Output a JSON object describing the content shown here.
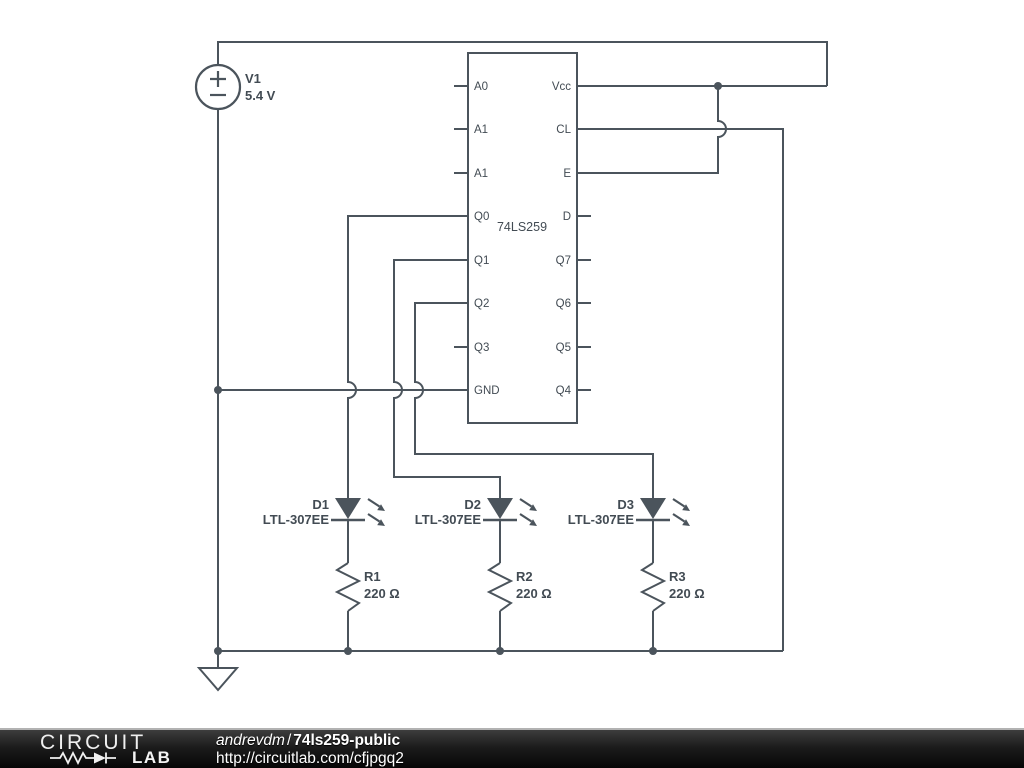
{
  "colors": {
    "wire": "#4b545c",
    "label": "#424b53",
    "footer_text": "#ffffff",
    "footer_bg_top": "#3d3d3d",
    "footer_bg_bottom": "#060606"
  },
  "schematic": {
    "voltage_source": {
      "name": "V1",
      "value": "5.4 V"
    },
    "ic": {
      "label": "74LS259",
      "left_pins": [
        "A0",
        "A1",
        "A1",
        "Q0",
        "Q1",
        "Q2",
        "Q3",
        "GND"
      ],
      "right_pins": [
        "Vcc",
        "CL",
        "E",
        "D",
        "Q7",
        "Q6",
        "Q5",
        "Q4"
      ]
    },
    "leds": [
      {
        "name": "D1",
        "part": "LTL-307EE"
      },
      {
        "name": "D2",
        "part": "LTL-307EE"
      },
      {
        "name": "D3",
        "part": "LTL-307EE"
      }
    ],
    "resistors": [
      {
        "name": "R1",
        "value": "220 Ω"
      },
      {
        "name": "R2",
        "value": "220 Ω"
      },
      {
        "name": "R3",
        "value": "220 Ω"
      }
    ]
  },
  "footer": {
    "logo_top": "CIRCUIT",
    "logo_bottom": "LAB",
    "author": "andrevdm",
    "separator": "/",
    "project": "74ls259-public",
    "url": "http://circuitlab.com/cfjpgq2"
  }
}
